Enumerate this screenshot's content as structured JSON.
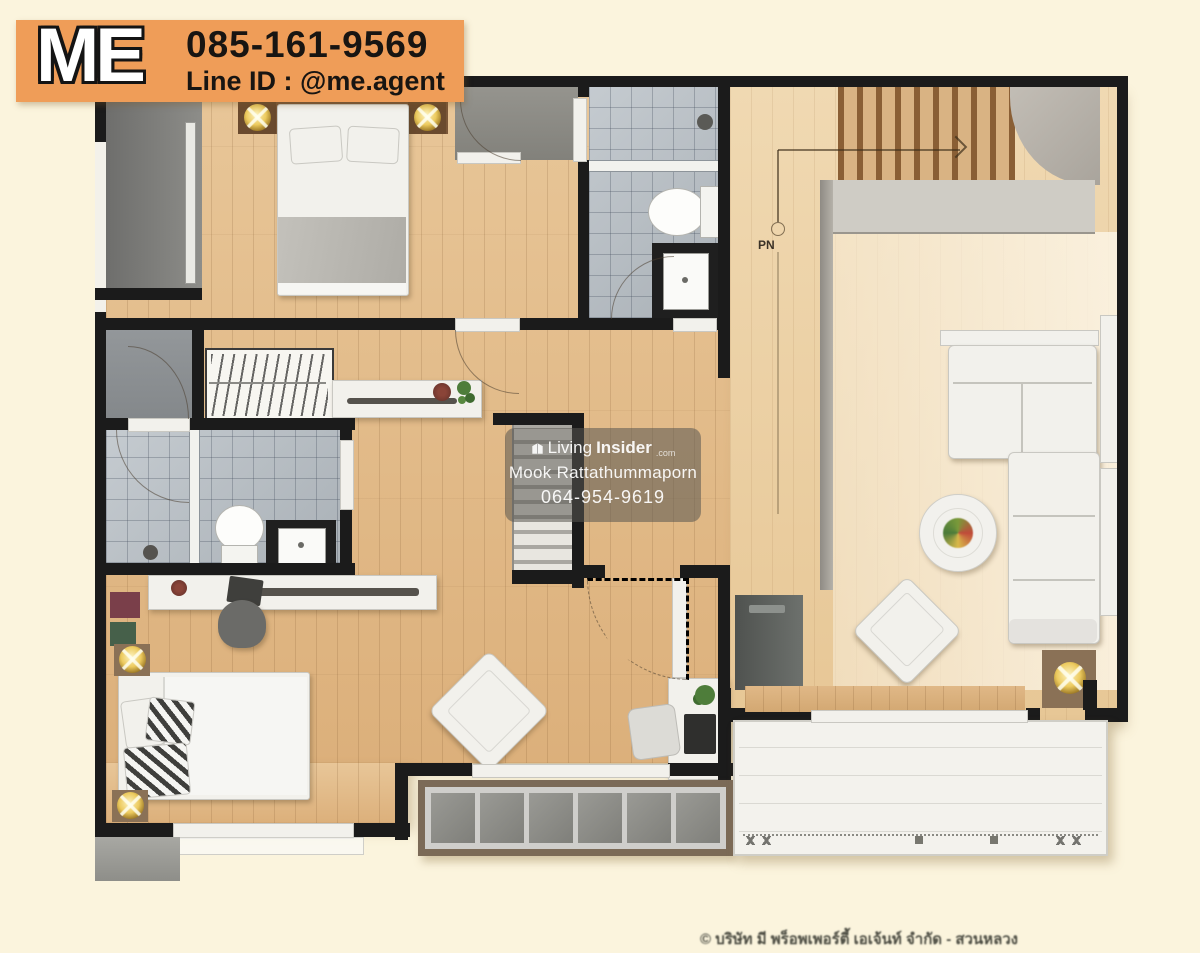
{
  "colors": {
    "page_bg": "#fbf4dd",
    "wall": "#1b1b1b",
    "banner_orange": "#ef9d58",
    "wood": "#e3bd8d",
    "wood_light": "#eed6b0",
    "tile": "#b9c0c6"
  },
  "banner": {
    "logo": "ME",
    "phone": "085-161-9569",
    "line_id": "Line ID : @me.agent"
  },
  "watermark": {
    "brand_light": "Living",
    "brand_bold": "Insider",
    "brand_tld": ".com",
    "agent_name": "Mook Rattathummaporn",
    "agent_phone": "064-954-9619"
  },
  "plan": {
    "stair_label": "PN"
  },
  "footer": {
    "copyright": "© บริษัท มี พร็อพเพอร์ตี้ เอเจ้นท์ จำกัด - สวนหลวง"
  }
}
